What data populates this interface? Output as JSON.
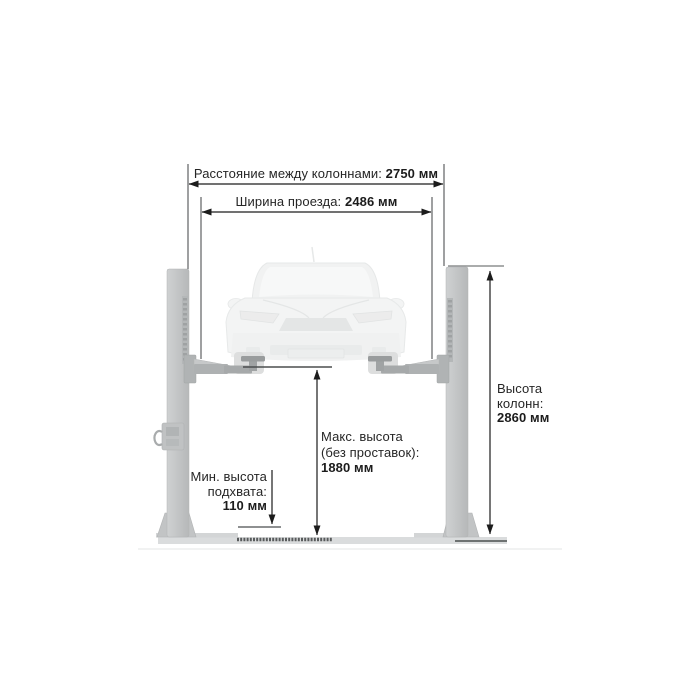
{
  "diagram": {
    "subject": "two-post car lift dimension drawing",
    "language": "ru",
    "unit": "мм",
    "colors": {
      "dimension_line": "#1c1c1c",
      "label_text": "#262626",
      "column_fill": "#c4c6c7",
      "floor_fill": "#dadcdd",
      "car_ghost_fill": "#f2f3f3"
    },
    "dimensions": {
      "column_spacing": {
        "label": "Расстояние между колоннами:",
        "value": "2750 мм"
      },
      "drive_width": {
        "label": "Ширина проезда:",
        "value": "2486 мм"
      },
      "column_height": {
        "label_line1": "Высота",
        "label_line2": "колонн:",
        "value": "2860 мм"
      },
      "max_height": {
        "label_line1": "Макс. высота",
        "label_line2": "(без проставок):",
        "value": "1880 мм"
      },
      "min_pickup_height": {
        "label_line1": "Мин. высота",
        "label_line2": "подхвата:",
        "value": "110 мм"
      }
    }
  }
}
